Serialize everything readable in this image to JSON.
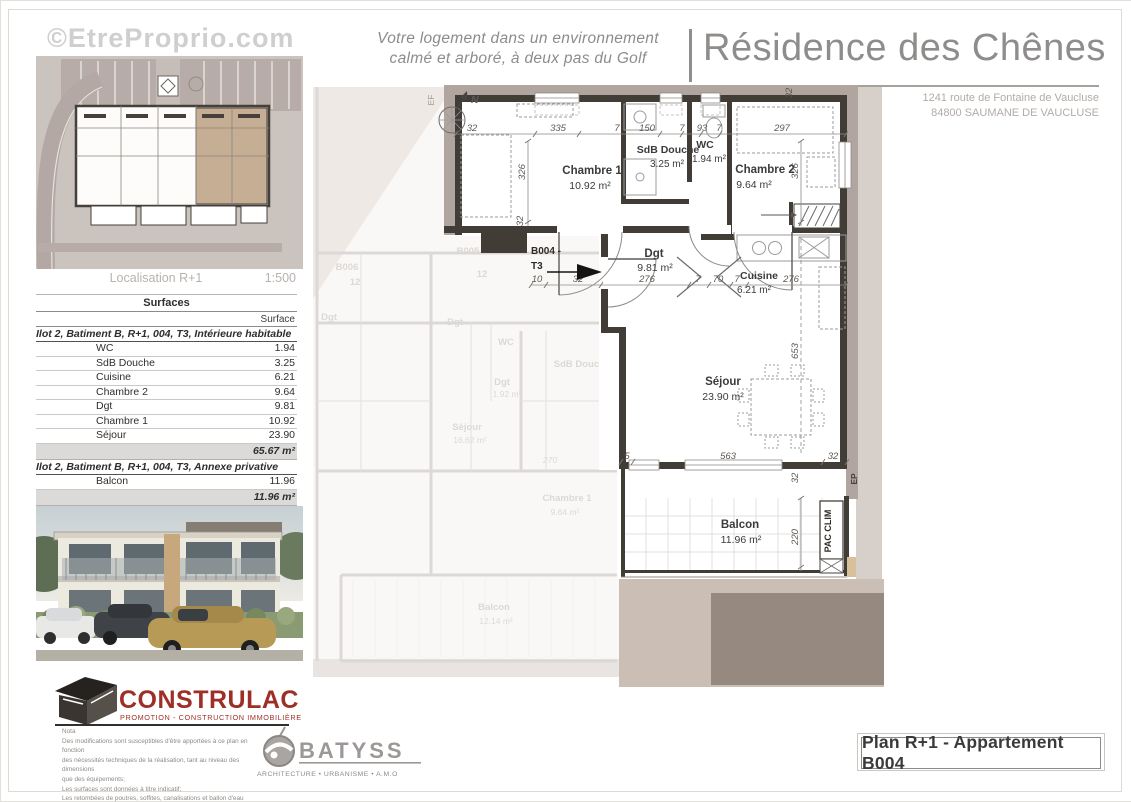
{
  "page": {
    "watermark": "©EtreProprio.com"
  },
  "header": {
    "tagline_line1": "Votre logement dans un environnement",
    "tagline_line2": "calmé et arboré, à deux pas du Golf",
    "title": "Résidence des Chênes",
    "address_line1": "1241 route de Fontaine de Vaucluse",
    "address_line2": "84800 SAUMANE DE VAUCLUSE"
  },
  "localisation": {
    "label": "Localisation R+1",
    "scale": "1:500"
  },
  "surfaces": {
    "title": "Surfaces",
    "column_header": "Surface",
    "sections": [
      {
        "header": "Ilot 2, Batiment B, R+1, 004, T3, Intérieure habitable",
        "rows": [
          {
            "label": "WC",
            "value": "1.94"
          },
          {
            "label": "SdB Douche",
            "value": "3.25"
          },
          {
            "label": "Cuisine",
            "value": "6.21"
          },
          {
            "label": "Chambre 2",
            "value": "9.64"
          },
          {
            "label": "Dgt",
            "value": "9.81"
          },
          {
            "label": "Chambre 1",
            "value": "10.92"
          },
          {
            "label": "Séjour",
            "value": "23.90"
          }
        ],
        "total": "65.67 m²"
      },
      {
        "header": "Ilot 2, Batiment B, R+1, 004, T3, Annexe privative",
        "rows": [
          {
            "label": "Balcon",
            "value": "11.96"
          }
        ],
        "total": "11.96 m²"
      }
    ]
  },
  "plan": {
    "unit_id": "B004 -",
    "unit_type": "T3",
    "north_label": "N",
    "rooms": [
      {
        "name": "Chambre 1",
        "area": "10.92 m²"
      },
      {
        "name": "SdB Douche",
        "area": "3.25 m²"
      },
      {
        "name": "WC",
        "area": "1.94 m²"
      },
      {
        "name": "Chambre 2",
        "area": "9.64 m²"
      },
      {
        "name": "Dgt",
        "area": "9.81 m²"
      },
      {
        "name": "Cuisine",
        "area": "6.21 m²"
      },
      {
        "name": "Séjour",
        "area": "23.90 m²"
      },
      {
        "name": "Balcon",
        "area": "11.96 m²"
      }
    ],
    "equipment": {
      "pac": "PAC CLIM",
      "ep": "EP",
      "ef": "EF"
    },
    "dims": {
      "top": [
        "32",
        "335",
        "7",
        "150",
        "7",
        "93",
        "7",
        "297"
      ],
      "mid": [
        "10",
        "32",
        "276",
        "7",
        "70",
        "7",
        "276"
      ],
      "bottom": [
        "5",
        "563",
        "32"
      ],
      "left": [
        "326",
        "32"
      ],
      "right": [
        "326",
        "653",
        "32",
        "220"
      ],
      "top_right": "32"
    }
  },
  "background_plan_labels": [
    "B006",
    "12",
    "B005",
    "12",
    "Dgt",
    "Dgt",
    "WC",
    "SdB Douche",
    "Dgt",
    "1.92 m²",
    "Séjour",
    "16.62 m²",
    "Chambre 1",
    "9.64 m²",
    "Balcon",
    "12.14 m²",
    "270"
  ],
  "logos": {
    "construlac": {
      "name": "CONSTRULAC",
      "tagline": "PROMOTION - CONSTRUCTION IMMOBILIÈRE"
    },
    "batyss": {
      "name": "BATYSS",
      "tagline": "ARCHITECTURE • URBANISME • A.M.O"
    }
  },
  "nota": {
    "lines": [
      "Nota",
      "Des modifications sont susceptibles d'être apportées à ce plan en fonction",
      "des nécessités techniques de la réalisation, tant au niveau des dimensions",
      "que des équipements;",
      "Les surfaces sont données à titre indicatif;",
      "Les retombées de poutres, soffites, canalisations et ballon d'eau chaude...",
      "et les équipements sont figurés à titre indicatif."
    ]
  },
  "title_block": {
    "text": "Plan R+1 - Appartement B004"
  },
  "colors": {
    "logo_red": "#9e2f27",
    "wall_dark": "#423c37",
    "exterior_band": "#b1a5a0",
    "highlight_tan": "#c5ae94"
  }
}
